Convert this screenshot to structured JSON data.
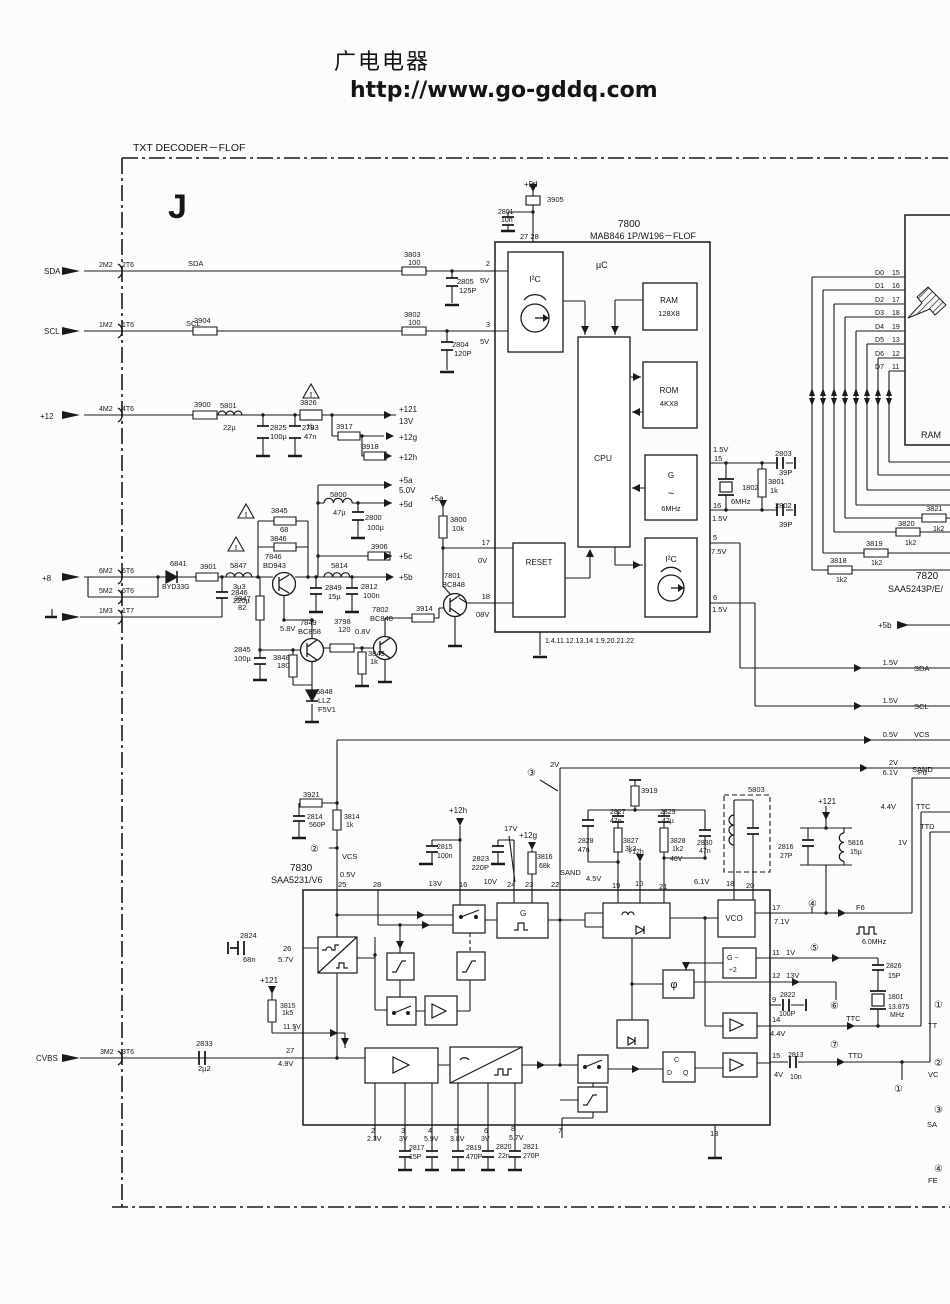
{
  "page": {
    "site_header": "广电电器",
    "site_url": "http://www.go-gddq.com"
  },
  "diagram": {
    "title": "TXT  DECODER－FLOF",
    "section_marker": "J",
    "ics": [
      {
        "ref": "7800",
        "part": "MAB846 1P/W196－FLOF",
        "blocks": [
          "I²C",
          "µC",
          "RAM 128X8",
          "ROM 4KX8",
          "CPU",
          "G ~ 6MHz",
          "RESET",
          "I²C"
        ]
      },
      {
        "ref": "7820",
        "part": "SAA5243P/E/"
      },
      {
        "ref": "7830",
        "part": "SAA5231/V6"
      }
    ],
    "left_inputs": [
      "SDA",
      "SCL",
      "+12",
      "+8",
      "GND",
      "CVBS"
    ],
    "right_signals": [
      "SDA",
      "SCL",
      "VCS",
      "SAND",
      "F6",
      "TTC",
      "TTD"
    ],
    "data_bus": [
      "D0",
      "D1",
      "D2",
      "D3",
      "D4",
      "D5",
      "D6",
      "D7"
    ]
  },
  "labels": [
    [
      133,
      151,
      "TXT  DECODER－FLOF",
      10.5
    ],
    [
      168,
      218,
      "J",
      34,
      0,
      1
    ],
    [
      524,
      187,
      "+5d",
      8
    ],
    [
      547,
      202,
      "3905"
    ],
    [
      498,
      214,
      "2801",
      7
    ],
    [
      501,
      222,
      "10n",
      7
    ],
    [
      520,
      239,
      "27 28"
    ],
    [
      618,
      227,
      "7800",
      10
    ],
    [
      590,
      239,
      "MAB846  1P/W196－FLOF",
      9
    ],
    [
      596,
      268,
      "µC",
      9
    ],
    [
      535,
      282,
      "I²C",
      8.5,
      1
    ],
    [
      669,
      303,
      "RAM",
      8,
      1
    ],
    [
      669,
      316,
      "128X8",
      7.5,
      1
    ],
    [
      669,
      393,
      "ROM",
      8,
      1
    ],
    [
      669,
      406,
      "4KX8",
      7.5,
      1
    ],
    [
      603,
      461,
      "CPU",
      8.5,
      1
    ],
    [
      671,
      478,
      "G",
      8,
      1
    ],
    [
      671,
      497,
      "~",
      11,
      1
    ],
    [
      671,
      511,
      "6MHz",
      7.5,
      1
    ],
    [
      539,
      565,
      "RESET",
      8,
      1
    ],
    [
      671,
      562,
      "I²C",
      8.5,
      1
    ],
    [
      545,
      643,
      "1.4.11.12.13.14 1.9.20.21.22",
      7
    ],
    [
      490,
      266,
      "2",
      7.5,
      2
    ],
    [
      480,
      283,
      "5V"
    ],
    [
      490,
      327,
      "3",
      7.5,
      2
    ],
    [
      480,
      344,
      "5V"
    ],
    [
      490,
      545,
      "17",
      7.5,
      2
    ],
    [
      478,
      563,
      "0V"
    ],
    [
      490,
      599,
      "18",
      7.5,
      2
    ],
    [
      476,
      617,
      "08V"
    ],
    [
      713,
      452,
      "1.5V"
    ],
    [
      714,
      461,
      "15"
    ],
    [
      775,
      456,
      "2803"
    ],
    [
      779,
      475,
      "39P"
    ],
    [
      742,
      490,
      "1802"
    ],
    [
      768,
      484,
      "3801"
    ],
    [
      770,
      493,
      "1k"
    ],
    [
      731,
      504,
      "6MHz"
    ],
    [
      713,
      508,
      "16"
    ],
    [
      775,
      508,
      "2802"
    ],
    [
      712,
      521,
      "1.5V"
    ],
    [
      779,
      527,
      "39P"
    ],
    [
      713,
      540,
      "5"
    ],
    [
      711,
      554,
      "7.5V"
    ],
    [
      713,
      600,
      "6"
    ],
    [
      712,
      612,
      "1.5V"
    ],
    [
      884,
      275,
      "D0",
      7,
      2
    ],
    [
      892,
      275,
      "15",
      7
    ],
    [
      884,
      288,
      "D1",
      7,
      2
    ],
    [
      892,
      288,
      "16",
      7
    ],
    [
      884,
      302,
      "D2",
      7,
      2
    ],
    [
      892,
      302,
      "17",
      7
    ],
    [
      884,
      315,
      "D3",
      7,
      2
    ],
    [
      892,
      315,
      "18",
      7
    ],
    [
      884,
      329,
      "D4",
      7,
      2
    ],
    [
      892,
      329,
      "19",
      7
    ],
    [
      884,
      342,
      "D5",
      7,
      2
    ],
    [
      892,
      342,
      "13",
      7
    ],
    [
      884,
      356,
      "D6",
      7,
      2
    ],
    [
      892,
      356,
      "12",
      7
    ],
    [
      884,
      369,
      "D7",
      7,
      2
    ],
    [
      892,
      369,
      "11",
      7
    ],
    [
      921,
      438,
      "RAM",
      9
    ],
    [
      926,
      511,
      "3821"
    ],
    [
      933,
      531,
      "1k2",
      7
    ],
    [
      898,
      526,
      "3820"
    ],
    [
      905,
      545,
      "1k2",
      7
    ],
    [
      866,
      546,
      "3819"
    ],
    [
      871,
      565,
      "1k2",
      7
    ],
    [
      830,
      563,
      "3818"
    ],
    [
      836,
      582,
      "1k2",
      7
    ],
    [
      916,
      579,
      "7820",
      10
    ],
    [
      888,
      592,
      "SAA5243P/E/",
      9
    ],
    [
      878,
      628,
      "+5b",
      8
    ],
    [
      898,
      665,
      "1.5V",
      7.5,
      2
    ],
    [
      914,
      671,
      "SDA"
    ],
    [
      898,
      703,
      "1.5V",
      7.5,
      2
    ],
    [
      914,
      709,
      "SCL"
    ],
    [
      898,
      737,
      "0.5V",
      7.5,
      2
    ],
    [
      914,
      737,
      "VCS"
    ],
    [
      898,
      765,
      "2V",
      7.5,
      2
    ],
    [
      912,
      772,
      "SAND"
    ],
    [
      898,
      775,
      "6.1V",
      7.5,
      2
    ],
    [
      918,
      775,
      "F6"
    ],
    [
      896,
      809,
      "4.4V",
      7.5,
      2
    ],
    [
      916,
      809,
      "TTC"
    ],
    [
      920,
      829,
      "TTD"
    ],
    [
      898,
      845,
      "1V"
    ],
    [
      44,
      274,
      "SDA",
      8
    ],
    [
      99,
      267,
      "2M2",
      7
    ],
    [
      122,
      267,
      "2T6",
      7
    ],
    [
      188,
      266,
      "SDA"
    ],
    [
      404,
      257,
      "3803"
    ],
    [
      408,
      265,
      "100"
    ],
    [
      457,
      284,
      "2805"
    ],
    [
      459,
      293,
      "125P"
    ],
    [
      44,
      334,
      "SCL",
      8
    ],
    [
      99,
      327,
      "1M2",
      7
    ],
    [
      122,
      327,
      "1T6",
      7
    ],
    [
      186,
      326,
      "SCL"
    ],
    [
      194,
      323,
      "3904"
    ],
    [
      404,
      317,
      "3802"
    ],
    [
      408,
      325,
      "100"
    ],
    [
      452,
      347,
      "2804"
    ],
    [
      454,
      356,
      "120P"
    ],
    [
      40,
      419,
      "+12",
      8
    ],
    [
      99,
      411,
      "4M2",
      7
    ],
    [
      122,
      411,
      "4T6",
      7
    ],
    [
      194,
      407,
      "3900"
    ],
    [
      220,
      408,
      "5801"
    ],
    [
      223,
      430,
      "22µ"
    ],
    [
      270,
      430,
      "2825"
    ],
    [
      270,
      439,
      "100µ"
    ],
    [
      302,
      430,
      "2793"
    ],
    [
      304,
      439,
      "47n"
    ],
    [
      300,
      405,
      "3826"
    ],
    [
      306,
      429,
      "1b"
    ],
    [
      399,
      412,
      "+121",
      8
    ],
    [
      399,
      424,
      "13V",
      8
    ],
    [
      336,
      429,
      "3917"
    ],
    [
      399,
      440,
      "+12g",
      8
    ],
    [
      362,
      449,
      "3918"
    ],
    [
      399,
      460,
      "+12h",
      8
    ],
    [
      42,
      581,
      "+8",
      8
    ],
    [
      99,
      573,
      "6M2",
      7
    ],
    [
      122,
      573,
      "6T6",
      7
    ],
    [
      99,
      593,
      "5M2",
      7
    ],
    [
      122,
      593,
      "5T6",
      7
    ],
    [
      99,
      613,
      "1M3",
      7
    ],
    [
      122,
      613,
      "1T7",
      7
    ],
    [
      170,
      566,
      "6841"
    ],
    [
      162,
      589,
      "BYD33G",
      7
    ],
    [
      200,
      569,
      "3901"
    ],
    [
      230,
      568,
      "5847"
    ],
    [
      233,
      589,
      "3µ3"
    ],
    [
      231,
      595,
      "2846"
    ],
    [
      233,
      603,
      "220µ"
    ],
    [
      271,
      513,
      "3845"
    ],
    [
      280,
      532,
      "68"
    ],
    [
      270,
      541,
      "3846"
    ],
    [
      265,
      559,
      "7846"
    ],
    [
      263,
      568,
      "BD943"
    ],
    [
      234,
      601,
      "3847"
    ],
    [
      238,
      610,
      "82"
    ],
    [
      234,
      652,
      "2845"
    ],
    [
      234,
      661,
      "100µ"
    ],
    [
      280,
      631,
      "5.8V"
    ],
    [
      300,
      625,
      "7849"
    ],
    [
      298,
      634,
      "BC858"
    ],
    [
      273,
      660,
      "3848"
    ],
    [
      277,
      668,
      "180"
    ],
    [
      316,
      694,
      "6848"
    ],
    [
      318,
      703,
      "LLZ"
    ],
    [
      318,
      712,
      "F5V1"
    ],
    [
      334,
      624,
      "3798"
    ],
    [
      338,
      632,
      "120"
    ],
    [
      355,
      634,
      "0.8V"
    ],
    [
      372,
      612,
      "7802"
    ],
    [
      370,
      621,
      "BC848"
    ],
    [
      368,
      656,
      "3849"
    ],
    [
      370,
      664,
      "1k"
    ],
    [
      416,
      611,
      "3914"
    ],
    [
      444,
      578,
      "7801"
    ],
    [
      442,
      587,
      "BC848"
    ],
    [
      430,
      501,
      "+5a",
      8
    ],
    [
      450,
      522,
      "3800"
    ],
    [
      452,
      531,
      "10k"
    ],
    [
      330,
      497,
      "5800"
    ],
    [
      333,
      515,
      "47µ"
    ],
    [
      399,
      483,
      "+5a",
      8
    ],
    [
      399,
      493,
      "5.0V",
      8
    ],
    [
      399,
      507,
      "+5d",
      8
    ],
    [
      365,
      520,
      "2800"
    ],
    [
      367,
      530,
      "100µ"
    ],
    [
      371,
      549,
      "3906"
    ],
    [
      399,
      559,
      "+5c",
      8
    ],
    [
      331,
      568,
      "5814"
    ],
    [
      399,
      580,
      "+5b",
      8
    ],
    [
      325,
      590,
      "2849"
    ],
    [
      328,
      599,
      "15µ"
    ],
    [
      361,
      589,
      "2812"
    ],
    [
      363,
      598,
      "100n"
    ],
    [
      36,
      1061,
      "CVBS",
      8
    ],
    [
      100,
      1054,
      "3M2",
      7
    ],
    [
      122,
      1054,
      "3T6",
      7
    ],
    [
      196,
      1046,
      "2833"
    ],
    [
      198,
      1071,
      "2µ2"
    ],
    [
      286,
      1053,
      "27"
    ],
    [
      278,
      1066,
      "4.9V"
    ],
    [
      240,
      938,
      "2824"
    ],
    [
      243,
      962,
      "68n"
    ],
    [
      283,
      951,
      "26"
    ],
    [
      278,
      962,
      "5.7V"
    ],
    [
      260,
      983,
      "+121",
      8
    ],
    [
      280,
      1008,
      "3815",
      7
    ],
    [
      282,
      1015,
      "1k5",
      7
    ],
    [
      283,
      1029,
      "11.5V",
      7
    ],
    [
      293,
      1031,
      "1",
      7
    ],
    [
      290,
      871,
      "7830",
      10
    ],
    [
      271,
      883,
      "SAA5231/V6",
      9
    ],
    [
      342,
      859,
      "VCS"
    ],
    [
      340,
      877,
      "0.5V"
    ],
    [
      338,
      887,
      "25"
    ],
    [
      373,
      887,
      "28"
    ],
    [
      449,
      813,
      "+12h",
      8
    ],
    [
      437,
      849,
      "2815",
      7
    ],
    [
      437,
      858,
      "100n",
      7
    ],
    [
      442,
      886,
      "13V",
      7.5,
      2
    ],
    [
      459,
      887,
      "16"
    ],
    [
      504,
      831,
      "17V"
    ],
    [
      489,
      861,
      "2823",
      7.5,
      2
    ],
    [
      489,
      870,
      "220P",
      7.5,
      2
    ],
    [
      497,
      884,
      "10V",
      7.5,
      2
    ],
    [
      507,
      887,
      "24"
    ],
    [
      519,
      838,
      "+12g",
      8
    ],
    [
      537,
      859,
      "3816",
      7
    ],
    [
      539,
      868,
      "68k",
      7
    ],
    [
      525,
      887,
      "23"
    ],
    [
      551,
      887,
      "22"
    ],
    [
      560,
      875,
      "SAND"
    ],
    [
      586,
      881,
      "4.5V"
    ],
    [
      641,
      793,
      "3919"
    ],
    [
      610,
      814,
      "2827",
      7
    ],
    [
      610,
      823,
      "47n",
      7
    ],
    [
      660,
      814,
      "2829",
      7
    ],
    [
      662,
      823,
      "47µ",
      7
    ],
    [
      578,
      843,
      "2828",
      7
    ],
    [
      578,
      852,
      "47n",
      7
    ],
    [
      623,
      843,
      "3827",
      7
    ],
    [
      625,
      851,
      "3k3",
      7
    ],
    [
      628,
      854,
      "+12h",
      7
    ],
    [
      670,
      843,
      "3828",
      7
    ],
    [
      672,
      851,
      "1k2",
      7
    ],
    [
      697,
      845,
      "2830",
      7
    ],
    [
      699,
      853,
      "47n",
      7
    ],
    [
      670,
      861,
      "46V",
      7
    ],
    [
      612,
      888,
      "19"
    ],
    [
      635,
      886,
      "10"
    ],
    [
      659,
      889,
      "21"
    ],
    [
      694,
      884,
      "6.1V"
    ],
    [
      726,
      886,
      "18"
    ],
    [
      746,
      888,
      "20"
    ],
    [
      748,
      792,
      "5803"
    ],
    [
      818,
      804,
      "+121",
      8
    ],
    [
      778,
      849,
      "2816",
      7
    ],
    [
      780,
      858,
      "27P",
      7
    ],
    [
      848,
      845,
      "5816",
      7
    ],
    [
      850,
      854,
      "15µ",
      7
    ],
    [
      527,
      776,
      "③",
      10
    ],
    [
      550,
      767,
      "2V"
    ],
    [
      520,
      916,
      "G",
      8
    ],
    [
      734,
      921,
      "VCO",
      8,
      1
    ],
    [
      772,
      910,
      "17"
    ],
    [
      774,
      924,
      "7.1V"
    ],
    [
      808,
      907,
      "④",
      10
    ],
    [
      856,
      910,
      "F6"
    ],
    [
      862,
      944,
      "6.0MHz",
      7
    ],
    [
      727,
      960,
      "G ~",
      7
    ],
    [
      729,
      972,
      "÷2",
      7
    ],
    [
      772,
      955,
      "11"
    ],
    [
      786,
      955,
      "1V"
    ],
    [
      810,
      951,
      "⑤",
      10
    ],
    [
      886,
      968,
      "2826",
      7
    ],
    [
      888,
      978,
      "15P",
      7
    ],
    [
      674,
      988,
      "φ",
      11,
      1
    ],
    [
      772,
      978,
      "12"
    ],
    [
      786,
      978,
      "13V"
    ],
    [
      830,
      1009,
      "⑥",
      10
    ],
    [
      772,
      1002,
      "9"
    ],
    [
      780,
      997,
      "2822",
      7
    ],
    [
      779,
      1016,
      "100P",
      7
    ],
    [
      888,
      999,
      "1801",
      7
    ],
    [
      888,
      1009,
      "13.875",
      7
    ],
    [
      890,
      1017,
      "MHz",
      7
    ],
    [
      846,
      1021,
      "TTC"
    ],
    [
      772,
      1022,
      "14"
    ],
    [
      770,
      1036,
      "4.4V"
    ],
    [
      830,
      1048,
      "⑦",
      10
    ],
    [
      674,
      1062,
      "C",
      7
    ],
    [
      667,
      1075,
      "D",
      7
    ],
    [
      683,
      1075,
      "Q",
      7
    ],
    [
      772,
      1058,
      "15"
    ],
    [
      774,
      1077,
      "4V"
    ],
    [
      788,
      1057,
      "2813",
      7
    ],
    [
      790,
      1079,
      "10n",
      7
    ],
    [
      848,
      1058,
      "TTD"
    ],
    [
      894,
      1092,
      "①",
      10
    ],
    [
      710,
      1136,
      "13"
    ],
    [
      371,
      1133,
      "2"
    ],
    [
      367,
      1141,
      "2.3V",
      7
    ],
    [
      401,
      1133,
      "3"
    ],
    [
      399,
      1141,
      "3V",
      7
    ],
    [
      409,
      1150,
      "2817",
      7
    ],
    [
      409,
      1159,
      "15P",
      7
    ],
    [
      428,
      1133,
      "4"
    ],
    [
      424,
      1141,
      "5.9V",
      7
    ],
    [
      454,
      1133,
      "5"
    ],
    [
      450,
      1141,
      "3.8V",
      7
    ],
    [
      466,
      1150,
      "2819",
      7
    ],
    [
      466,
      1159,
      "470P",
      7
    ],
    [
      484,
      1133,
      "6"
    ],
    [
      481,
      1141,
      "3V",
      7
    ],
    [
      496,
      1149,
      "2820",
      7
    ],
    [
      498,
      1158,
      "22n",
      7
    ],
    [
      511,
      1131,
      "8"
    ],
    [
      509,
      1140,
      "5.7V",
      7
    ],
    [
      523,
      1149,
      "2821",
      7
    ],
    [
      523,
      1158,
      "270P",
      7
    ],
    [
      558,
      1133,
      "7"
    ],
    [
      934,
      1008,
      "①",
      10
    ],
    [
      928,
      1028,
      "TT"
    ],
    [
      934,
      1066,
      "②",
      10
    ],
    [
      928,
      1077,
      "VC"
    ],
    [
      934,
      1113,
      "③",
      10
    ],
    [
      927,
      1127,
      "SA"
    ],
    [
      934,
      1172,
      "④",
      10
    ],
    [
      928,
      1183,
      "FE"
    ],
    [
      310,
      852,
      "②",
      10
    ],
    [
      303,
      797,
      "3921"
    ],
    [
      307,
      819,
      "2814",
      7
    ],
    [
      309,
      827,
      "560P",
      7
    ],
    [
      344,
      819,
      "3814",
      7
    ],
    [
      346,
      827,
      "1k",
      7
    ],
    [
      246,
      517,
      "!",
      7,
      1,
      1
    ],
    [
      236,
      550,
      "!",
      7,
      1,
      1
    ],
    [
      311,
      397,
      "!",
      7,
      1,
      1
    ]
  ]
}
